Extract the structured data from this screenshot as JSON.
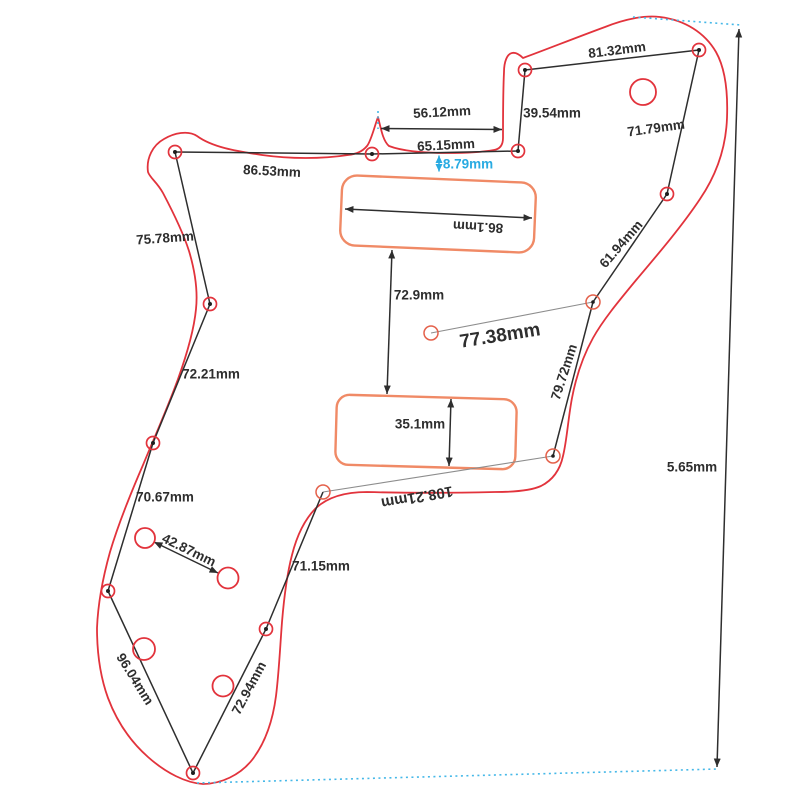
{
  "figure": {
    "type": "technical-drawing",
    "subject": "guitar pickguard dimensional drawing",
    "unit": "mm",
    "dimensions": {
      "top_edge": "86.53mm",
      "neck_notch_width": "56.12mm",
      "neck_edge": "65.15mm",
      "neck_offset": "8.79mm",
      "notch_height": "39.54mm",
      "upper_edge": "81.32mm",
      "upper_right_edge": "71.79mm",
      "right_edge_upper": "61.94mm",
      "pickup_distance": "77.38mm",
      "right_edge_lower": "79.72mm",
      "pickup_gap": "72.9mm",
      "neck_pickup_width": "86.1mm",
      "bridge_pickup_height": "35.1mm",
      "bridge_edge": "108.21mm",
      "lower_right_edge": "71.15mm",
      "left_edge_upper": "75.78mm",
      "left_edge_mid": "72.21mm",
      "left_edge_lower": "70.67mm",
      "bottom_left_edge": "96.04mm",
      "bottom_right_edge": "72.94mm",
      "pot_spacing": "42.87mm",
      "side_offset": "5.65mm"
    },
    "colors": {
      "outline_red": "#e2333c",
      "pickup_orange": "#f08a66",
      "marker_orange": "#e4604a",
      "dimension_dark": "#2e2e2e",
      "accent_cyan": "#29abe2",
      "thin_gray": "#8d8d8d"
    }
  }
}
